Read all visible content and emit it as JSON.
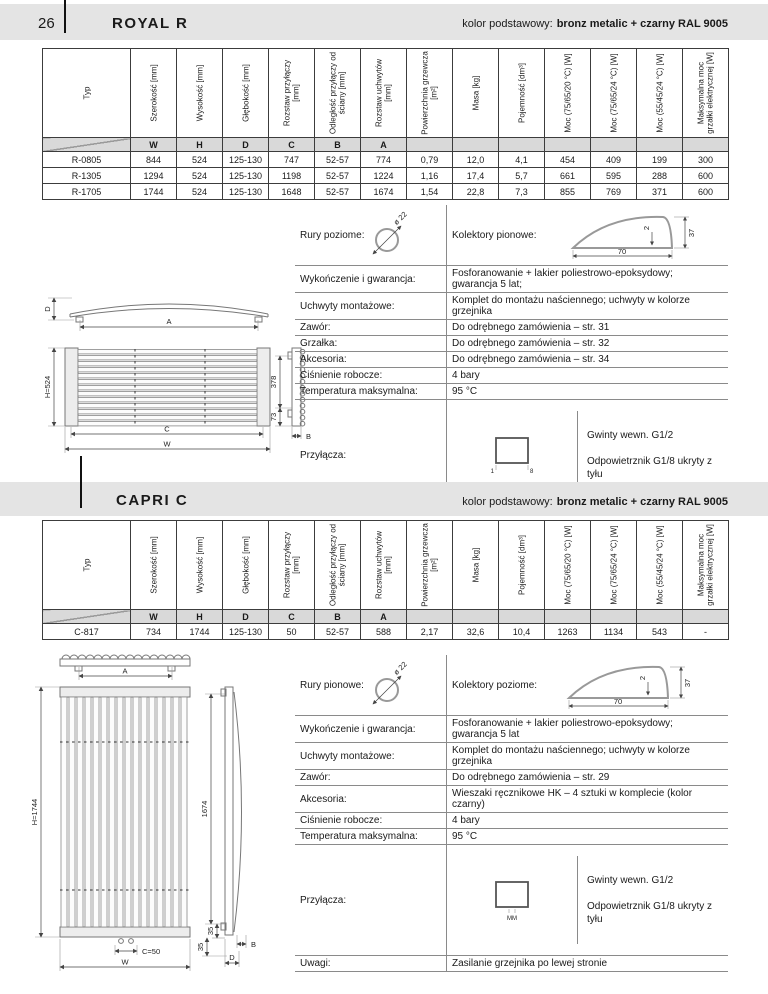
{
  "page": {
    "number": "26"
  },
  "kolor": {
    "label": "kolor podstawowy:",
    "value": "bronz metalic + czarny RAL 9005"
  },
  "columns": [
    "Typ",
    "Szerokość [mm]",
    "Wysokość [mm]",
    "Głębokość [mm]",
    "Rozstaw przyłączy [mm]",
    "Odległość przyłączy od ściany [mm]",
    "Rozstaw uchwytów [mm]",
    "Powierzchnia grzewcza [m²]",
    "Masa [kg]",
    "Pojemność [dm³]",
    "Moc (75/65/20 °C) [W]",
    "Moc (75/65/24 °C) [W]",
    "Moc (55/45/24 °C) [W]",
    "Maksymalna moc grzałki elektrycznej [W]"
  ],
  "letters": [
    "W",
    "H",
    "D",
    "C",
    "B",
    "A"
  ],
  "royal": {
    "title": "ROYAL R",
    "rows": [
      {
        "cells": [
          "R-0805",
          "844",
          "524",
          "125-130",
          "747",
          "52-57",
          "774",
          "0,79",
          "12,0",
          "4,1",
          "454",
          "409",
          "199",
          "300"
        ]
      },
      {
        "cells": [
          "R-1305",
          "1294",
          "524",
          "125-130",
          "1198",
          "52-57",
          "1224",
          "1,16",
          "17,4",
          "5,7",
          "661",
          "595",
          "288",
          "600"
        ]
      },
      {
        "cells": [
          "R-1705",
          "1744",
          "524",
          "125-130",
          "1648",
          "52-57",
          "1674",
          "1,54",
          "22,8",
          "7,3",
          "855",
          "769",
          "371",
          "600"
        ]
      }
    ]
  },
  "capri": {
    "title": "CAPRI C",
    "rows": [
      {
        "cells": [
          "C-817",
          "734",
          "1744",
          "125-130",
          "50",
          "52-57",
          "588",
          "2,17",
          "32,6",
          "10,4",
          "1263",
          "1134",
          "543",
          "-"
        ]
      }
    ]
  },
  "royal_info": {
    "pipes_label": "Rury poziome:",
    "pipes_dim": "ø 22",
    "collectors_label": "Kolektory pionowe:",
    "collector": {
      "w": "70",
      "h": "37",
      "t": "2"
    },
    "rows": [
      {
        "label": "Wykończenie i gwarancja:",
        "value": "Fosforanowanie + lakier poliestrowo-epoksydowy;\ngwarancja 5 lat;"
      },
      {
        "label": "Uchwyty montażowe:",
        "value": "Komplet do montażu naściennego; uchwyty w kolorze grzejnika"
      },
      {
        "label": "Zawór:",
        "value": "Do odrębnego zamówienia – str. 31"
      },
      {
        "label": "Grzałka:",
        "value": "Do odrębnego zamówienia – str. 32"
      },
      {
        "label": "Akcesoria:",
        "value": "Do odrębnego zamówienia – str. 34"
      },
      {
        "label": "Ciśnienie robocze:",
        "value": "4 bary"
      },
      {
        "label": "Temperatura maksymalna:",
        "value": "95 °C"
      }
    ],
    "przylacza": {
      "label": "Przyłącza:",
      "sq_left": "1",
      "sq_right": "8",
      "line1": "Gwinty wewn. G1/2",
      "line2": "Odpowietrznik G1/8 ukryty z tyłu"
    }
  },
  "capri_info": {
    "pipes_label": "Rury pionowe:",
    "pipes_dim": "ø 22",
    "collectors_label": "Kolektory poziome:",
    "collector": {
      "w": "70",
      "h": "37",
      "t": "2"
    },
    "rows": [
      {
        "label": "Wykończenie i gwarancja:",
        "value": "Fosforanowanie + lakier poliestrowo-epoksydowy;\ngwarancja 5 lat"
      },
      {
        "label": "Uchwyty montażowe:",
        "value": "Komplet do montażu naściennego; uchwyty w kolorze grzejnika"
      },
      {
        "label": "Zawór:",
        "value": "Do odrębnego zamówienia – str. 29"
      },
      {
        "label": "Akcesoria:",
        "value": "Wieszaki ręcznikowe HK – 4 sztuki w komplecie (kolor czarny)"
      },
      {
        "label": "Ciśnienie robocze:",
        "value": "4 bary"
      },
      {
        "label": "Temperatura maksymalna:",
        "value": "95 °C"
      }
    ],
    "przylacza": {
      "label": "Przyłącza:",
      "sq_caption": "MM",
      "line1": "Gwinty wewn. G1/2",
      "line2": "Odpowietrznik G1/8 ukryty z tyłu"
    },
    "uwagi": {
      "label": "Uwagi:",
      "value": "Zasilanie grzejnika po lewej stronie"
    }
  },
  "royal_drawing": {
    "top": {
      "d": "D",
      "a": "A"
    },
    "front": {
      "h": "H=524",
      "c": "C",
      "w": "W"
    },
    "side": {
      "v1": "378",
      "v2": "73",
      "b": "B"
    }
  },
  "capri_drawing": {
    "top": {
      "a": "A"
    },
    "front": {
      "h": "H=1744",
      "c": "C=50",
      "w": "W"
    },
    "side": {
      "v1": "1674",
      "v2": "35",
      "v3": "35",
      "b": "B",
      "d": "D"
    }
  }
}
